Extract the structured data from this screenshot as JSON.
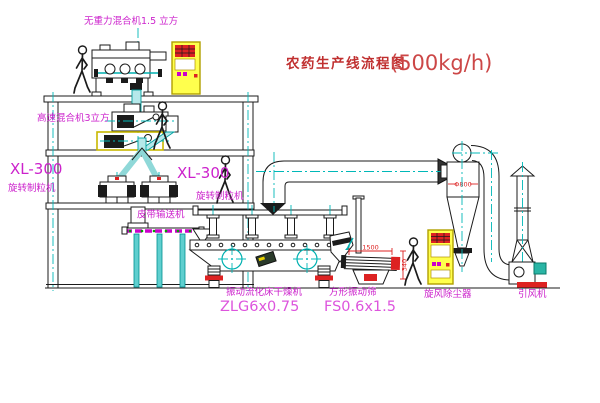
{
  "title": {
    "text": "农药生产线流程图",
    "capacity": "(500kg/h)"
  },
  "equipment": {
    "gravity_mixer": {
      "label": "无重力混合机1.5 立方"
    },
    "high_speed_mixer": {
      "label": "高速混合机3立方"
    },
    "granulator_left": {
      "model": "XL-300",
      "label": "旋转制粒机"
    },
    "granulator_right": {
      "model": "XL-300",
      "label": "旋转制粒机"
    },
    "belt_conveyor": {
      "label": "皮带输送机"
    },
    "fluid_bed_dryer": {
      "label": "振动流化床干燥机",
      "model": "ZLG6x0.75"
    },
    "vibrating_screen": {
      "label": "方形振动筛",
      "model": "FS0.6x1.5",
      "dim_length": "1500",
      "dim_height": "340"
    },
    "cyclone": {
      "label": "旋风除尘器",
      "dim_diameter": "Φ800"
    },
    "fan": {
      "label": "引风机"
    }
  },
  "colors": {
    "line": "#1b1b1b",
    "centerline_cyan": "#00b8b8",
    "chute_fill": "#b5e8ea",
    "label_magenta": "#cc22cc",
    "model_pink": "#dd55dd",
    "title_red": "#c03030",
    "dimension_red": "#dd2222",
    "cabinet_yellow": "#ffff4d",
    "belt_green_dot": "#00a000",
    "motor_teal": "#2ab5a5"
  }
}
